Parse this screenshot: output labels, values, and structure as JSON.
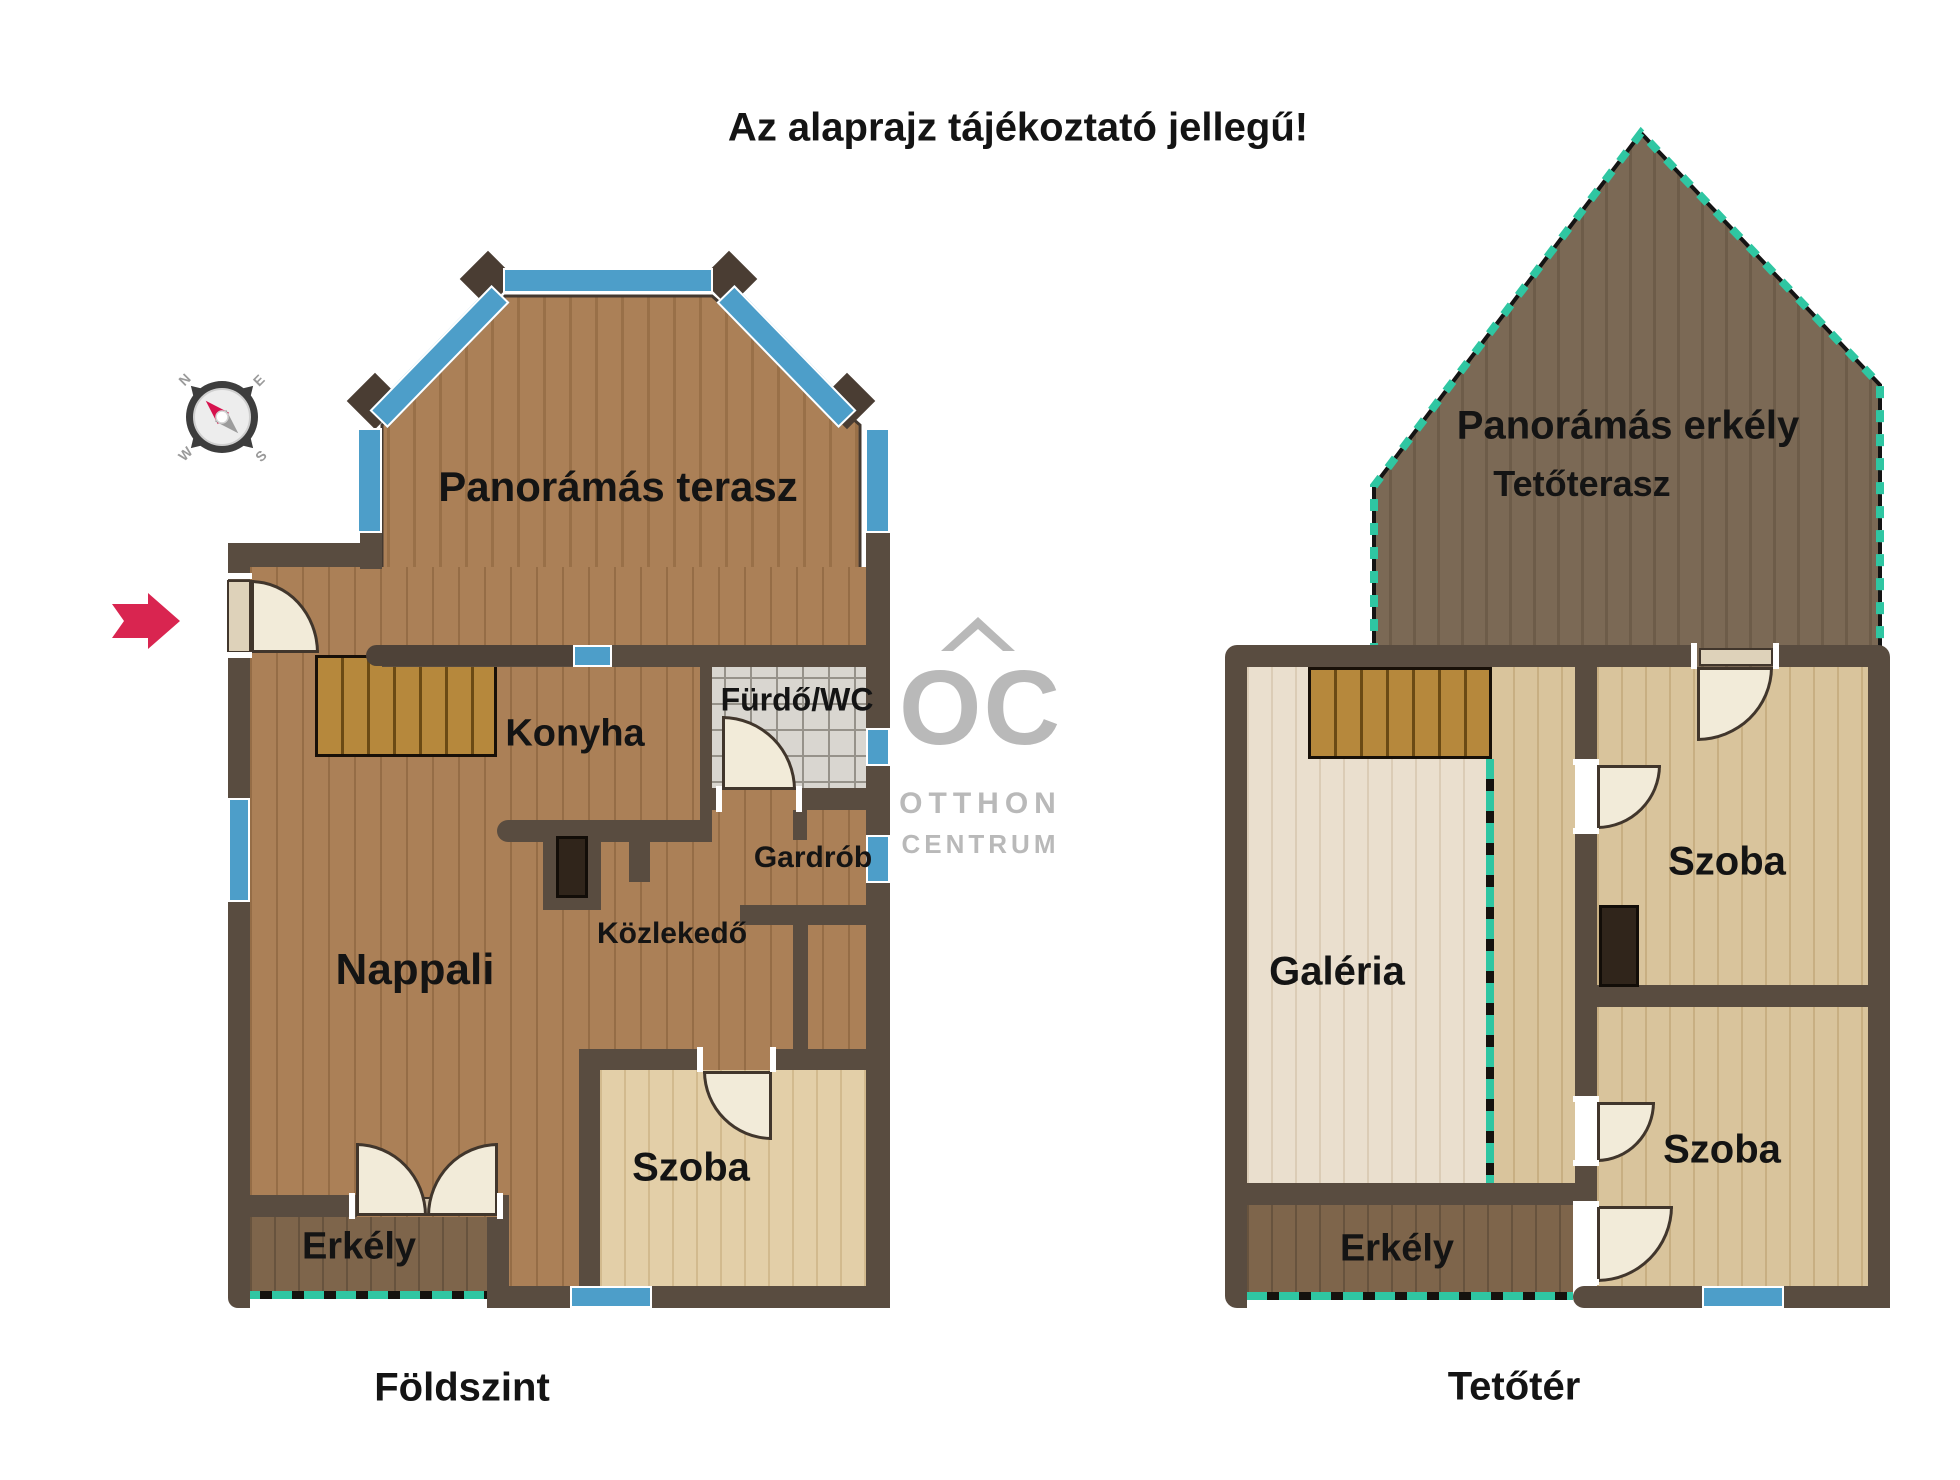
{
  "page_title": "Az alaprajz tájékoztató jellegű!",
  "logo": {
    "monogram": "OC",
    "line1": "OTTHON",
    "line2": "CENTRUM"
  },
  "compass": {
    "north": "N",
    "east": "E",
    "south": "S",
    "west": "W"
  },
  "ground": {
    "caption": "Földszint",
    "terrace": "Panorámás terasz",
    "kitchen": "Konyha",
    "bathroom": "Fürdő/WC",
    "wardrobe": "Gardrób",
    "corridor": "Közlekedő",
    "living": "Nappali",
    "bedroom": "Szoba",
    "balcony": "Erkély"
  },
  "attic": {
    "caption": "Tetőtér",
    "pano_balcony": "Panorámás erkély",
    "roof_terrace": "Tetőterasz",
    "gallery": "Galéria",
    "bedroom_upper": "Szoba",
    "bedroom_lower": "Szoba",
    "balcony": "Erkély"
  },
  "colors": {
    "wall": "#594c40",
    "window_blue": "#4d9ec9",
    "railing_teal": "#2fc6a2",
    "entry_arrow_red": "#d92550",
    "logo_gray": "#b9b9b9"
  }
}
